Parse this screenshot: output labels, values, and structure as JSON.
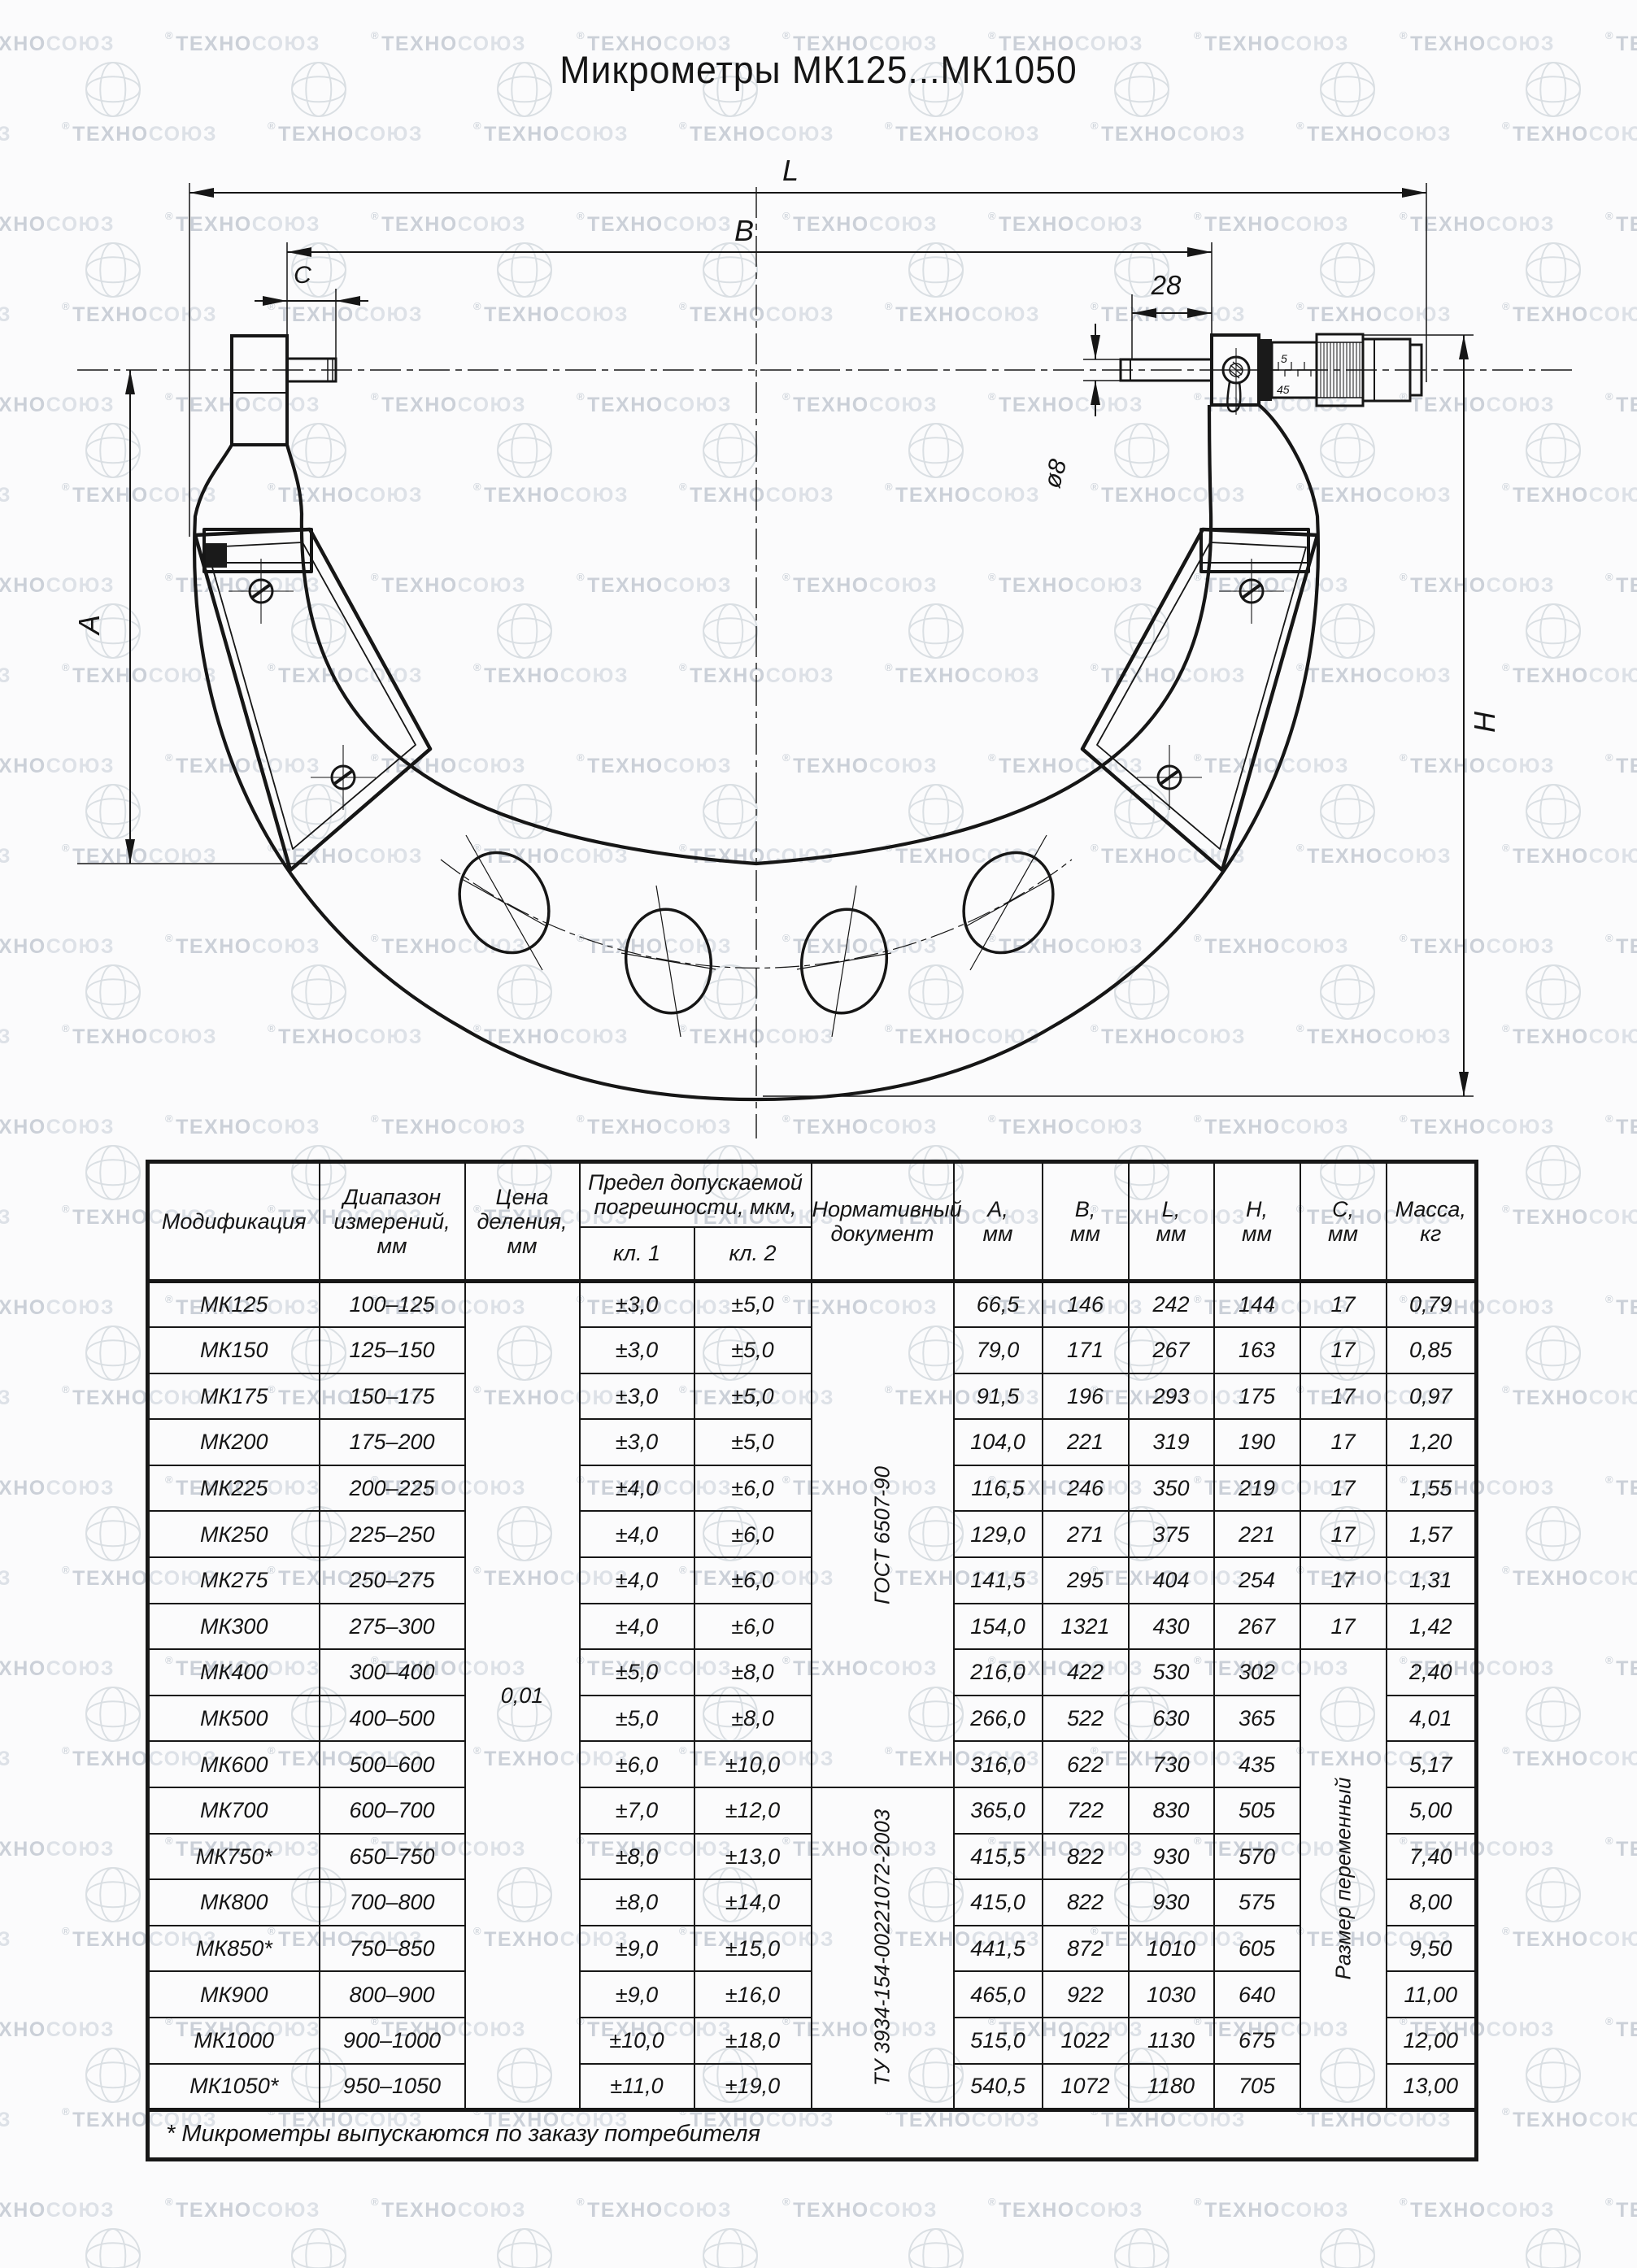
{
  "page": {
    "title": "Микрометры МК125...МК1050"
  },
  "watermark": {
    "registered": "®",
    "brand_bold": "ТЕХНО",
    "brand_light": "СОЮЗ"
  },
  "drawing": {
    "dim_labels": {
      "L": "L",
      "B": "B",
      "C": "C",
      "n28": "28",
      "d8": "ø8",
      "A": "A",
      "H": "H"
    },
    "scale_marks": {
      "top": "5",
      "bottom": "45"
    }
  },
  "table": {
    "headers": {
      "modification": [
        "Модификация"
      ],
      "range": [
        "Диапазон",
        "измерений,",
        "мм"
      ],
      "division": [
        "Цена",
        "деления,",
        "мм"
      ],
      "error": [
        "Предел допускаемой",
        "погрешности, мкм,"
      ],
      "kl1": [
        "кл. 1"
      ],
      "kl2": [
        "кл. 2"
      ],
      "norm": [
        "Нормативный",
        "документ"
      ],
      "a": [
        "А,",
        "мм"
      ],
      "b": [
        "В,",
        "мм"
      ],
      "l": [
        "L,",
        "мм"
      ],
      "h": [
        "Н,",
        "мм"
      ],
      "c": [
        "С,",
        "мм"
      ],
      "mass": [
        "Масса,",
        "кг"
      ]
    },
    "rows": [
      {
        "model": "МК125",
        "range": "100–125",
        "kl1": "±3,0",
        "kl2": "±5,0",
        "a": "66,5",
        "b": "146",
        "l": "242",
        "h": "144",
        "c": "17",
        "mass": "0,79"
      },
      {
        "model": "МК150",
        "range": "125–150",
        "kl1": "±3,0",
        "kl2": "±5,0",
        "a": "79,0",
        "b": "171",
        "l": "267",
        "h": "163",
        "c": "17",
        "mass": "0,85"
      },
      {
        "model": "МК175",
        "range": "150–175",
        "kl1": "±3,0",
        "kl2": "±5,0",
        "a": "91,5",
        "b": "196",
        "l": "293",
        "h": "175",
        "c": "17",
        "mass": "0,97"
      },
      {
        "model": "МК200",
        "range": "175–200",
        "kl1": "±3,0",
        "kl2": "±5,0",
        "a": "104,0",
        "b": "221",
        "l": "319",
        "h": "190",
        "c": "17",
        "mass": "1,20"
      },
      {
        "model": "МК225",
        "range": "200–225",
        "kl1": "±4,0",
        "kl2": "±6,0",
        "a": "116,5",
        "b": "246",
        "l": "350",
        "h": "219",
        "c": "17",
        "mass": "1,55"
      },
      {
        "model": "МК250",
        "range": "225–250",
        "kl1": "±4,0",
        "kl2": "±6,0",
        "a": "129,0",
        "b": "271",
        "l": "375",
        "h": "221",
        "c": "17",
        "mass": "1,57"
      },
      {
        "model": "МК275",
        "range": "250–275",
        "kl1": "±4,0",
        "kl2": "±6,0",
        "a": "141,5",
        "b": "295",
        "l": "404",
        "h": "254",
        "c": "17",
        "mass": "1,31"
      },
      {
        "model": "МК300",
        "range": "275–300",
        "kl1": "±4,0",
        "kl2": "±6,0",
        "a": "154,0",
        "b": "1321",
        "l": "430",
        "h": "267",
        "c": "17",
        "mass": "1,42"
      },
      {
        "model": "МК400",
        "range": "300–400",
        "kl1": "±5,0",
        "kl2": "±8,0",
        "a": "216,0",
        "b": "422",
        "l": "530",
        "h": "302",
        "mass": "2,40"
      },
      {
        "model": "МК500",
        "range": "400–500",
        "kl1": "±5,0",
        "kl2": "±8,0",
        "a": "266,0",
        "b": "522",
        "l": "630",
        "h": "365",
        "mass": "4,01"
      },
      {
        "model": "МК600",
        "range": "500–600",
        "kl1": "±6,0",
        "kl2": "±10,0",
        "a": "316,0",
        "b": "622",
        "l": "730",
        "h": "435",
        "mass": "5,17"
      },
      {
        "model": "МК700",
        "range": "600–700",
        "kl1": "±7,0",
        "kl2": "±12,0",
        "a": "365,0",
        "b": "722",
        "l": "830",
        "h": "505",
        "mass": "5,00"
      },
      {
        "model": "МК750*",
        "range": "650–750",
        "kl1": "±8,0",
        "kl2": "±13,0",
        "a": "415,5",
        "b": "822",
        "l": "930",
        "h": "570",
        "mass": "7,40"
      },
      {
        "model": "МК800",
        "range": "700–800",
        "kl1": "±8,0",
        "kl2": "±14,0",
        "a": "415,0",
        "b": "822",
        "l": "930",
        "h": "575",
        "mass": "8,00"
      },
      {
        "model": "МК850*",
        "range": "750–850",
        "kl1": "±9,0",
        "kl2": "±15,0",
        "a": "441,5",
        "b": "872",
        "l": "1010",
        "h": "605",
        "mass": "9,50"
      },
      {
        "model": "МК900",
        "range": "800–900",
        "kl1": "±9,0",
        "kl2": "±16,0",
        "a": "465,0",
        "b": "922",
        "l": "1030",
        "h": "640",
        "mass": "11,00"
      },
      {
        "model": "МК1000",
        "range": "900–1000",
        "kl1": "±10,0",
        "kl2": "±18,0",
        "a": "515,0",
        "b": "1022",
        "l": "1130",
        "h": "675",
        "mass": "12,00"
      },
      {
        "model": "МК1050*",
        "range": "950–1050",
        "kl1": "±11,0",
        "kl2": "±19,0",
        "a": "540,5",
        "b": "1072",
        "l": "1180",
        "h": "705",
        "mass": "13,00"
      }
    ],
    "merged": {
      "division_value": "0,01",
      "norm_doc_1": "ГОСТ 6507-90",
      "norm_doc_1_rows": 11,
      "norm_doc_2": "ТУ 3934-154-00221072-2003",
      "norm_doc_2_rows": 7,
      "c_merged_text": "Размер переменный",
      "c_merged_start": 8,
      "c_merged_rows": 10
    },
    "footnote": "* Микрометры выпускаются по заказу потребителя"
  }
}
